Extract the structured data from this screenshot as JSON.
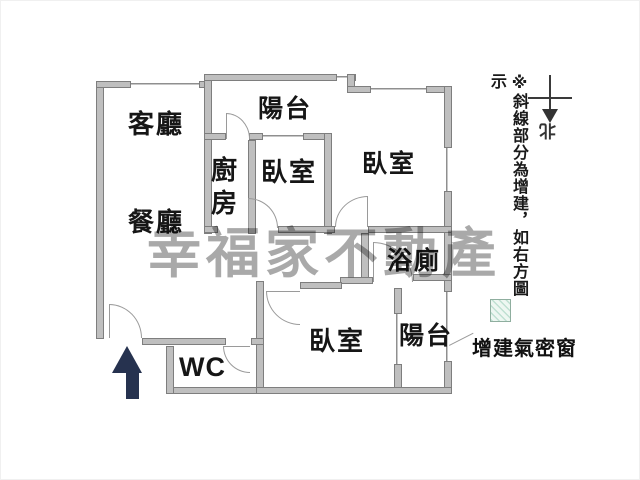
{
  "watermark": {
    "text": "幸福家不動產"
  },
  "rooms": {
    "living": "客廳",
    "dining": "餐廳",
    "balcony_top": "陽台",
    "kitchen": "廚房",
    "bedroom_mid": "臥室",
    "bedroom_right": "臥室",
    "bathroom": "浴廁",
    "bedroom_bottom": "臥室",
    "balcony_bottom": "陽台",
    "wc": "WC"
  },
  "annotations": {
    "note": "※斜線部分為增建，如右方圖示",
    "window_label": "增建氣密窗",
    "compass_north": "北"
  },
  "colors": {
    "wall_fill": "#bfbfbf",
    "wall_edge": "#7e7e7e",
    "entrance_arrow": "#26324f",
    "watermark_gray": "#a9a9a9",
    "hatch_line": "#bfe0d2",
    "hatch_bg": "#eef7f2"
  }
}
